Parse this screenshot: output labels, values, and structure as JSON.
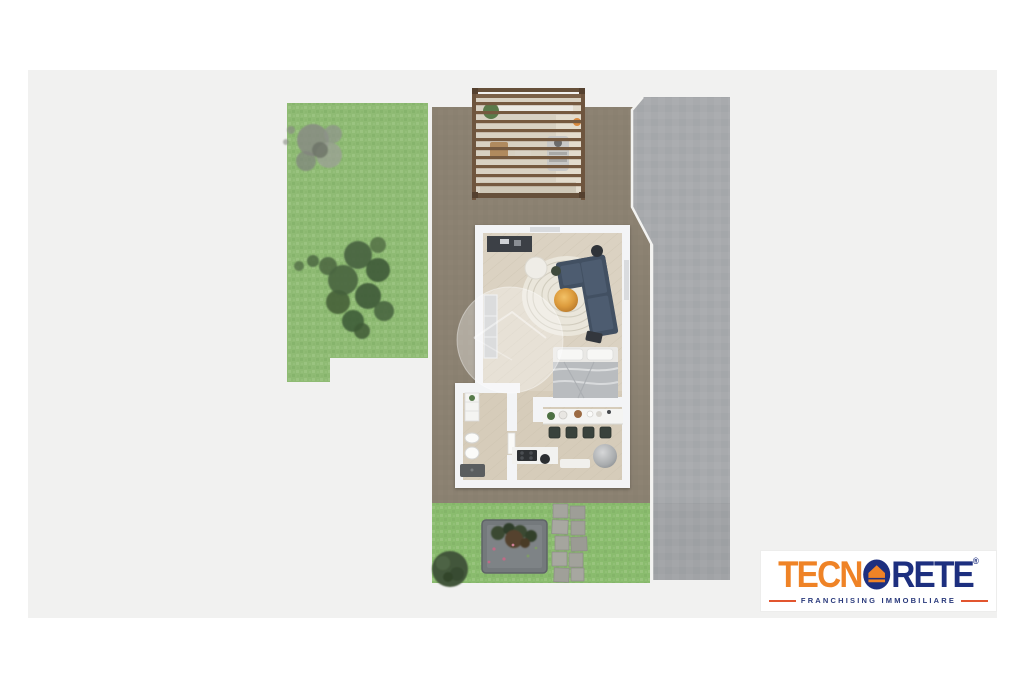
{
  "logo": {
    "brand_part1": "TECN",
    "brand_part2": "RETE",
    "registered_mark": "®",
    "tagline": "FRANCHISING IMMOBILIARE",
    "colors": {
      "orange": "#ef8326",
      "blue": "#1d2f7f",
      "tagline_line": "#e2552f",
      "tagline_text": "#2a3a7c",
      "box_background": "#ffffff"
    }
  },
  "scene": {
    "type": "3d-top-down-floor-plan",
    "colors": {
      "page_background": "#ffffff",
      "photo_background": "#f1f1f0",
      "grass": "#8fbb74",
      "terrace": "#8b8171",
      "driveway": "#a8aaad",
      "house_wall": "#f3f4f6",
      "wood_floor": "#dbd2c2",
      "pergola_wood": "#75593f",
      "sofa": "#425062",
      "pouf": "#d99a3c",
      "rug": "#eae6db",
      "bed_duvet": "#b9bcbf",
      "tv_cabinet": "#3c4046",
      "shower_tray": "#5a5d5f",
      "stone_path": "#a5a59e",
      "planter_box": "#74797c",
      "bush": "#42573a",
      "watermark": "rgba(255,255,255,0.33)"
    }
  }
}
